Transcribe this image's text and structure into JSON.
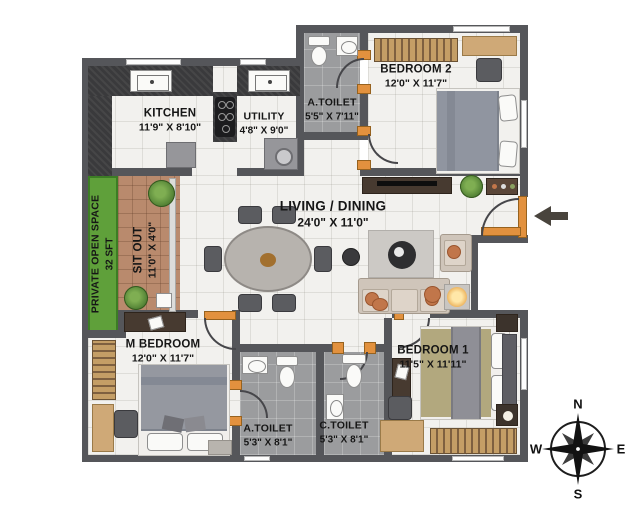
{
  "rooms": {
    "kitchen": {
      "name": "KITCHEN",
      "dims": "11'9\" X 8'10\""
    },
    "utility": {
      "name": "UTILITY",
      "dims": "4'8\" X 9'0\""
    },
    "a_toilet_top": {
      "name": "A.TOILET",
      "dims": "5'5\" X 7'11\""
    },
    "bedroom2": {
      "name": "BEDROOM 2",
      "dims": "12'0\" X 11'7\""
    },
    "living_dining": {
      "name": "LIVING / DINING",
      "dims": "24'0\" X 11'0\""
    },
    "private_open_space": {
      "name": "PRIVATE OPEN SPACE",
      "dims": "32 SFT"
    },
    "sit_out": {
      "name": "SIT OUT",
      "dims": "11'0\" X 4'0\""
    },
    "m_bedroom": {
      "name": "M BEDROOM",
      "dims": "12'0\" X 11'7\""
    },
    "a_toilet_bottom": {
      "name": "A.TOILET",
      "dims": "5'3\" X 8'1\""
    },
    "c_toilet": {
      "name": "C.TOILET",
      "dims": "5'3\" X 8'1\""
    },
    "bedroom1": {
      "name": "BEDROOM 1",
      "dims": "11'5\" X 11'11\""
    }
  },
  "compass": {
    "north": "N",
    "south": "S",
    "east": "E",
    "west": "W"
  },
  "furniture_icons": {
    "kitchen": [
      "sink-icon",
      "hob-icon",
      "fridge-icon",
      "l-counter-icon"
    ],
    "utility": [
      "sink-icon",
      "washing-machine-icon"
    ],
    "a_toilet_top": [
      "toilet-icon",
      "washbasin-icon"
    ],
    "bedroom2": [
      "wardrobe-icon",
      "study-desk-icon",
      "chair-icon",
      "double-bed-icon"
    ],
    "living_dining": [
      "dining-table-icon",
      "dining-chair-icon",
      "tv-console-icon",
      "plant-icon",
      "cabinet-icon",
      "coffee-table-icon",
      "sofa-icon",
      "armchair-icon",
      "floor-lamp-icon",
      "pouf-icon"
    ],
    "sit_out": [
      "plant-icon",
      "step-box-icon"
    ],
    "m_bedroom": [
      "tv-unit-icon",
      "wardrobe-icon",
      "double-bed-icon",
      "desk-icon",
      "chair-icon",
      "rug-icon"
    ],
    "a_toilet_bottom": [
      "washbasin-icon",
      "toilet-icon"
    ],
    "c_toilet": [
      "toilet-icon",
      "washbasin-icon"
    ],
    "bedroom1": [
      "tv-cabinet-icon",
      "double-bed-icon",
      "nightstand-icon",
      "desk-icon",
      "chair-icon",
      "wardrobe-icon"
    ]
  },
  "colors": {
    "wall": "#55565a",
    "floor_tile": "#f2f1ee",
    "toilet_floor": "#9b9c9e",
    "green_space": "#5fa03a",
    "sit_out_tile": "#b98a6d",
    "door_frame_orange": "#e2913e",
    "counter_dark": "#3a3a3c",
    "wood_tan": "#cfa977",
    "dark_wood": "#473a30",
    "accent_orange": "#c1764a"
  }
}
